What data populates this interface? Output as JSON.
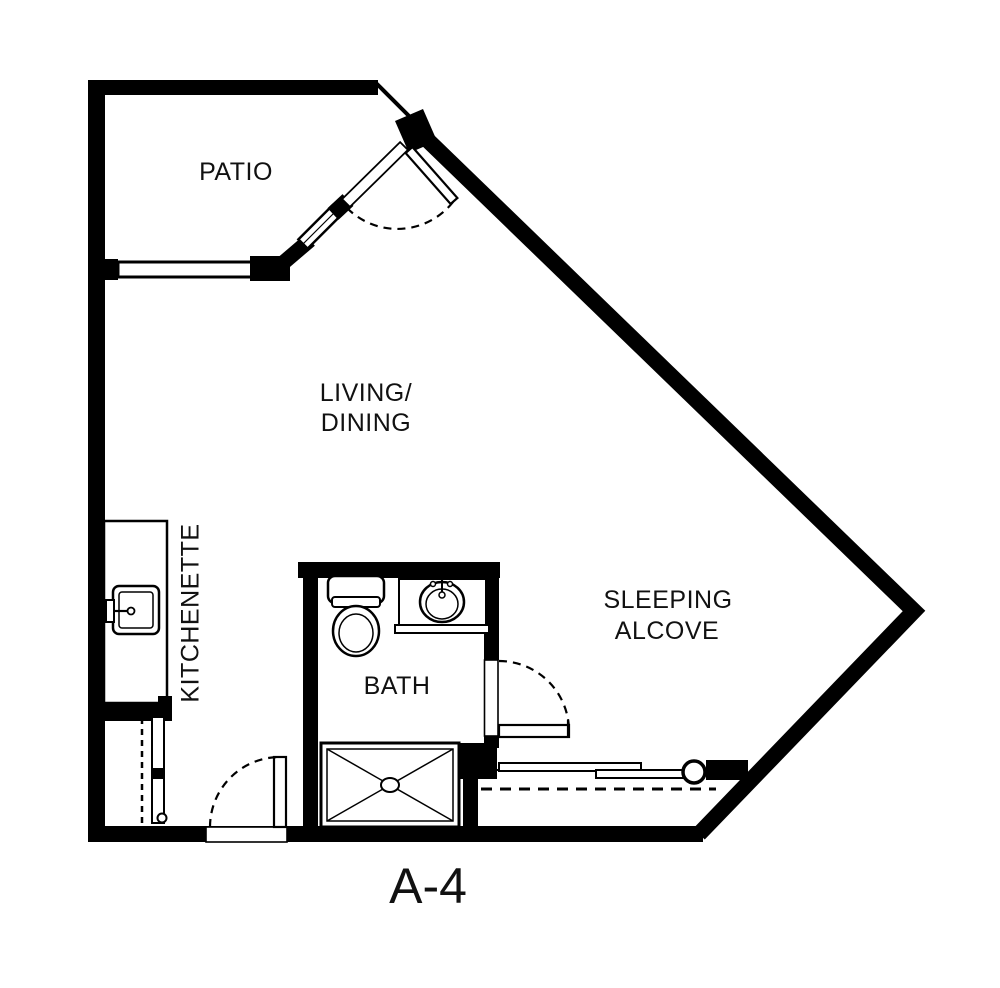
{
  "plan_title": "A-4",
  "rooms": {
    "patio": {
      "label": "PATIO"
    },
    "living_dining": {
      "line1": "LIVING/",
      "line2": "DINING"
    },
    "kitchenette": {
      "label": "KITCHENETTE"
    },
    "bath": {
      "label": "BATH"
    },
    "sleeping_alcove": {
      "line1": "SLEEPING",
      "line2": "ALCOVE"
    }
  },
  "icons": {
    "kitchen_sink": "kitchen-sink-icon",
    "toilet": "toilet-icon",
    "bathroom_sink": "bathroom-sink-icon",
    "shower": "shower-stall-icon"
  },
  "colors": {
    "walls": "#000000",
    "background": "#ffffff",
    "text": "#111111"
  }
}
